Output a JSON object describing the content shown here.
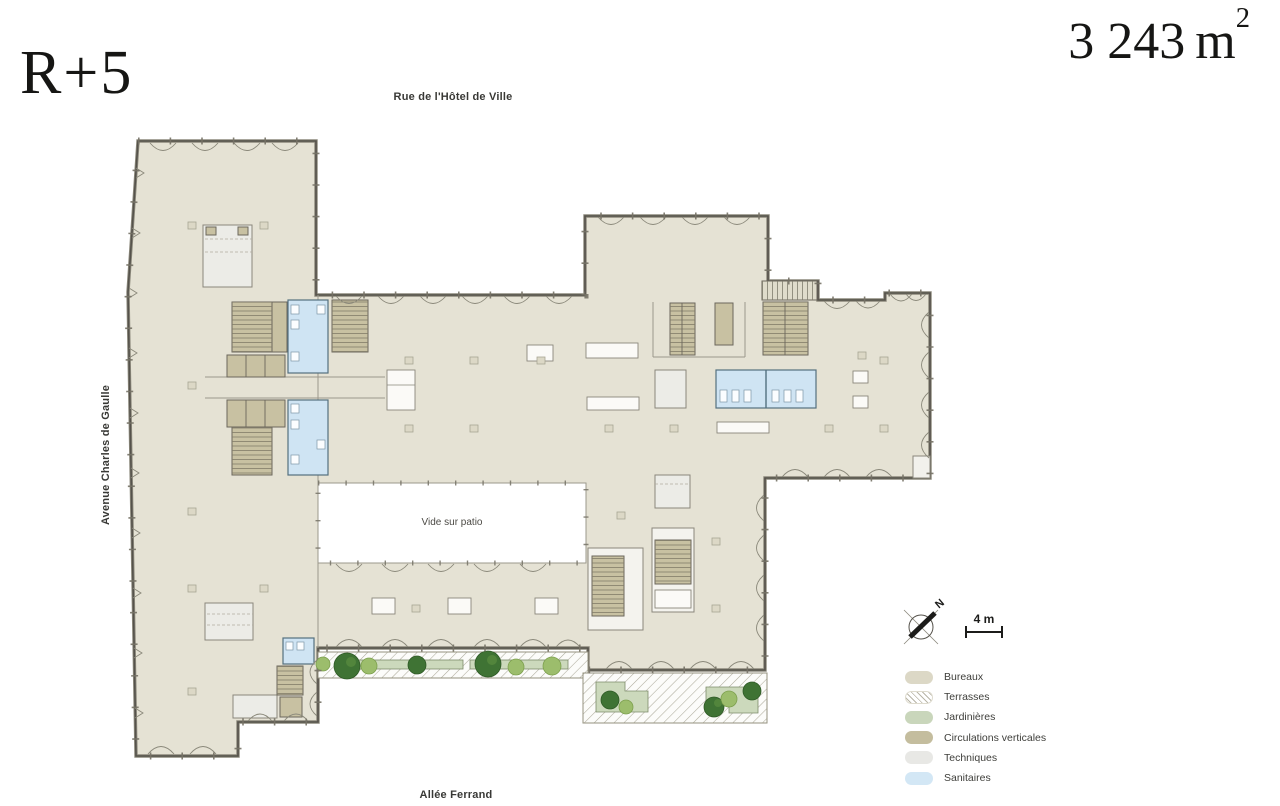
{
  "title": {
    "floor": "R+5"
  },
  "area": {
    "value": "3 243",
    "unit": "m",
    "exponent": "2"
  },
  "streets": {
    "top": "Rue de l'Hôtel de Ville",
    "left": "Avenue Charles de Gaulle",
    "bottom": "Allée Ferrand"
  },
  "annotations": {
    "patio": "Vide sur patio"
  },
  "compass": {
    "north": "N"
  },
  "scale": {
    "label": "4 m"
  },
  "legend": {
    "items": [
      {
        "label": "Bureaux",
        "key": "bureaux",
        "color": "#dcd8c6"
      },
      {
        "label": "Terrasses",
        "key": "terrasses",
        "color": "#ffffff"
      },
      {
        "label": "Jardinières",
        "key": "jardinieres",
        "color": "#c9d6bb"
      },
      {
        "label": "Circulations verticales",
        "key": "circulations",
        "color": "#c4bd9e"
      },
      {
        "label": "Techniques",
        "key": "techniques",
        "color": "#e8e8e5"
      },
      {
        "label": "Sanitaires",
        "key": "sanitaires",
        "color": "#d3e7f5"
      }
    ]
  },
  "plan_colors": {
    "bureaux_fill": "#e5e2d4",
    "walls": "#55524b",
    "terrace_hatch": "#aeab9c",
    "planter_fill": "#ccd9bc",
    "tree_dark": "#3f7334",
    "tree_light": "#9cbd6c",
    "sanitaires_fill": "#cfe4f3",
    "circulations_fill": "#c8c1a2",
    "techniques_fill": "#ecece7"
  }
}
